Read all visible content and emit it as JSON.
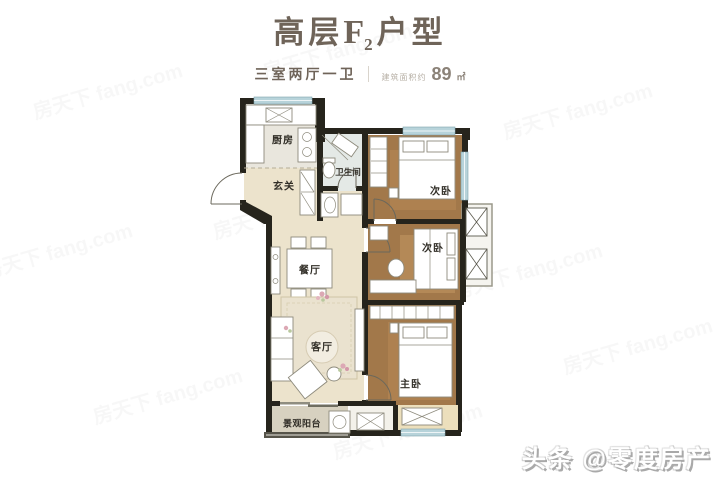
{
  "header": {
    "title_prefix": "高层",
    "title_unit": "F",
    "title_unit_sub": "2",
    "title_suffix": "户型",
    "subtitle_rooms": "三室两厅一卫",
    "area_label": "建筑面积约",
    "area_value": "89",
    "area_unit": "㎡",
    "title_color": "#6f6459"
  },
  "floorplan": {
    "rooms": [
      {
        "id": "kitchen",
        "label": "厨房"
      },
      {
        "id": "entry",
        "label": "玄关"
      },
      {
        "id": "bathroom",
        "label": "卫生间"
      },
      {
        "id": "bedroom2a",
        "label": "次卧"
      },
      {
        "id": "bedroom2b",
        "label": "次卧"
      },
      {
        "id": "dining",
        "label": "餐厅"
      },
      {
        "id": "living",
        "label": "客厅"
      },
      {
        "id": "master",
        "label": "主卧"
      },
      {
        "id": "balcony",
        "label": "景观阳台"
      }
    ],
    "colors": {
      "wall": "#26241c",
      "wood_floor": "#a2784a",
      "tile_floor": "#ece3cc",
      "kitchen_floor": "#e9e6dd",
      "bath_floor": "#e4e9e6",
      "window": "#b7d3da",
      "balcony_floor": "#d7d1c0",
      "rug": "#eae2cf"
    }
  },
  "watermarks": {
    "diagonal_text": "房天下 fang.com",
    "brand_text": "头条 @零度房产"
  }
}
